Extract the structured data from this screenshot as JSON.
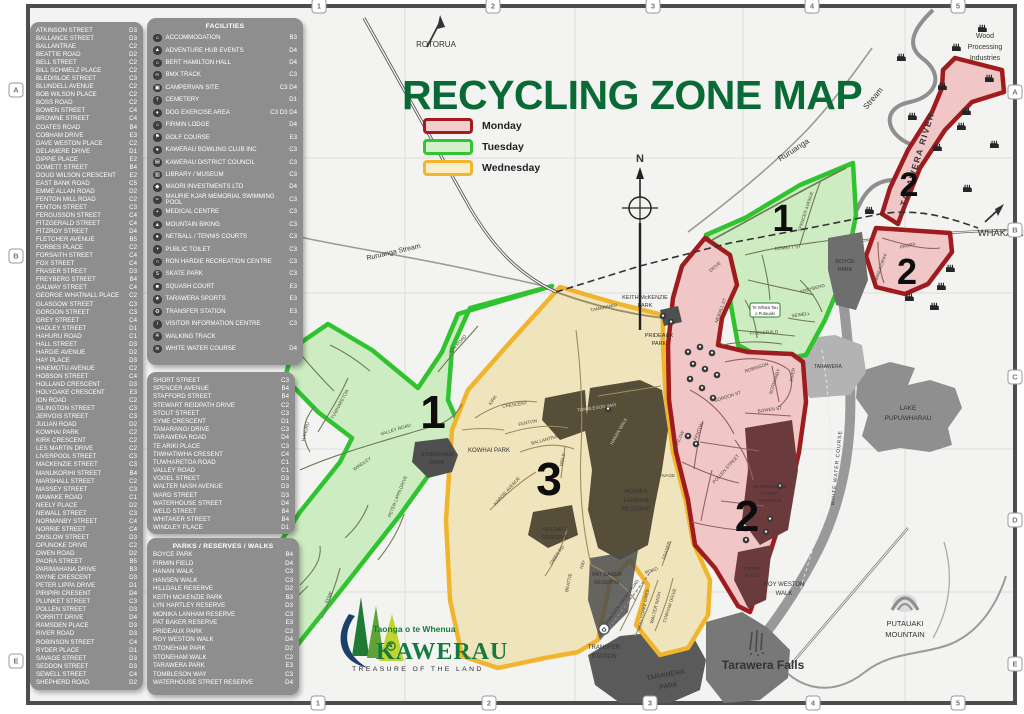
{
  "title": "RECYCLING ZONE MAP",
  "legend": {
    "items": [
      {
        "label": "Monday",
        "stroke": "#A6191E",
        "fill": "#F2CFCF"
      },
      {
        "label": "Tuesday",
        "stroke": "#33C433",
        "fill": "#D5EFCB"
      },
      {
        "label": "Wednesday",
        "stroke": "#F2B52D",
        "fill": "#F7EFC9"
      }
    ]
  },
  "grid": {
    "cols": [
      "1",
      "2",
      "3",
      "4",
      "5"
    ],
    "rows": [
      "A",
      "B",
      "C",
      "D",
      "E"
    ]
  },
  "streets_panel_1": {
    "items": [
      {
        "name": "ATKINSON STREET",
        "ref": "D3"
      },
      {
        "name": "BALLANCE STREET",
        "ref": "D3"
      },
      {
        "name": "BALLANTRAE",
        "ref": "C2"
      },
      {
        "name": "BEATTIE ROAD",
        "ref": "D2"
      },
      {
        "name": "BELL STREET",
        "ref": "C2"
      },
      {
        "name": "BILL SCHMELZ PLACE",
        "ref": "C2"
      },
      {
        "name": "BLEDISLOE STREET",
        "ref": "C3"
      },
      {
        "name": "BLUNDELL AVENUE",
        "ref": "C2"
      },
      {
        "name": "BOB WILSON PLACE",
        "ref": "C2"
      },
      {
        "name": "BOSS ROAD",
        "ref": "C2"
      },
      {
        "name": "BOWEN STREET",
        "ref": "C4"
      },
      {
        "name": "BROWNE STREET",
        "ref": "C4"
      },
      {
        "name": "COATES ROAD",
        "ref": "B4"
      },
      {
        "name": "COBHAM DRIVE",
        "ref": "E3"
      },
      {
        "name": "DAVE WESTON PLACE",
        "ref": "C2"
      },
      {
        "name": "DELAMERE DRIVE",
        "ref": "D1"
      },
      {
        "name": "DIPPIE PLACE",
        "ref": "E2"
      },
      {
        "name": "DOMETT STREET",
        "ref": "B4"
      },
      {
        "name": "DOUG WILSON CRESCENT",
        "ref": "E2"
      },
      {
        "name": "EAST BANK ROAD",
        "ref": "C5"
      },
      {
        "name": "EMME ALLAN ROAD",
        "ref": "D2"
      },
      {
        "name": "FENTON MILL ROAD",
        "ref": "C2"
      },
      {
        "name": "FENTON STREET",
        "ref": "C3"
      },
      {
        "name": "FERGUSSON STREET",
        "ref": "C4"
      },
      {
        "name": "FITZGERALD STREET",
        "ref": "C4"
      },
      {
        "name": "FITZROY STREET",
        "ref": "D4"
      },
      {
        "name": "FLETCHER AVENUE",
        "ref": "B5"
      },
      {
        "name": "FORBES PLACE",
        "ref": "C2"
      },
      {
        "name": "FORSAITH STREET",
        "ref": "C4"
      },
      {
        "name": "FOX STREET",
        "ref": "C4"
      },
      {
        "name": "FRASER STREET",
        "ref": "D3"
      },
      {
        "name": "FREYBERG STREET",
        "ref": "B4"
      },
      {
        "name": "GALWAY STREET",
        "ref": "C4"
      },
      {
        "name": "GEORGE WHATNALL PLACE",
        "ref": "C2"
      },
      {
        "name": "GLASGOW STREET",
        "ref": "C3"
      },
      {
        "name": "GORDON STREET",
        "ref": "C3"
      },
      {
        "name": "GREY STREET",
        "ref": "C4"
      },
      {
        "name": "HADLEY STREET",
        "ref": "D1"
      },
      {
        "name": "HAHURU ROAD",
        "ref": "C1"
      },
      {
        "name": "HALL STREET",
        "ref": "D3"
      },
      {
        "name": "HARDIE AVENUE",
        "ref": "D2"
      },
      {
        "name": "HAY PLACE",
        "ref": "D3"
      },
      {
        "name": "HINEMOTU AVENUE",
        "ref": "C2"
      },
      {
        "name": "HOBSON STREET",
        "ref": "C4"
      },
      {
        "name": "HOLLAND CRESCENT",
        "ref": "D3"
      },
      {
        "name": "HOLYOAKE CRESCENT",
        "ref": "E3"
      },
      {
        "name": "ION ROAD",
        "ref": "C2"
      },
      {
        "name": "ISLINGTON STREET",
        "ref": "C3"
      },
      {
        "name": "JERVOIS STREET",
        "ref": "C3"
      },
      {
        "name": "JULIAN ROAD",
        "ref": "D2"
      },
      {
        "name": "KOWHAI PARK",
        "ref": "C2"
      },
      {
        "name": "KIRK CRESCENT",
        "ref": "C2"
      },
      {
        "name": "LES MARTIN DRIVE",
        "ref": "C2"
      },
      {
        "name": "LIVERPOOL STREET",
        "ref": "C3"
      },
      {
        "name": "MACKENZIE STREET",
        "ref": "C3"
      },
      {
        "name": "MANUKORIHI STREET",
        "ref": "B4"
      },
      {
        "name": "MARSHALL STREET",
        "ref": "C2"
      },
      {
        "name": "MASSEY STREET",
        "ref": "C3"
      },
      {
        "name": "MAWAKE ROAD",
        "ref": "C1"
      },
      {
        "name": "NEELY PLACE",
        "ref": "D2"
      },
      {
        "name": "NEWALL STREET",
        "ref": "C3"
      },
      {
        "name": "NORMANBY STREET",
        "ref": "C4"
      },
      {
        "name": "NORRIE STREET",
        "ref": "C4"
      },
      {
        "name": "ONSLOW STREET",
        "ref": "D3"
      },
      {
        "name": "OPUNOKE DRIVE",
        "ref": "C2"
      },
      {
        "name": "OWEN ROAD",
        "ref": "D2"
      },
      {
        "name": "PAORA STREET",
        "ref": "B5"
      },
      {
        "name": "PARIMAHANA DRIVE",
        "ref": "B3"
      },
      {
        "name": "PAYNE CRESCENT",
        "ref": "D3"
      },
      {
        "name": "PETER LIPPA DRIVE",
        "ref": "D1"
      },
      {
        "name": "PIRIPIRI CRESENT",
        "ref": "D4"
      },
      {
        "name": "PLUNKET STREET",
        "ref": "C3"
      },
      {
        "name": "POLLEN STREET",
        "ref": "D3"
      },
      {
        "name": "PORRITT DRIVE",
        "ref": "D4"
      },
      {
        "name": "RAMSDEN PLACE",
        "ref": "D3"
      },
      {
        "name": "RIVER ROAD",
        "ref": "D3"
      },
      {
        "name": "ROBINSON STREET",
        "ref": "C4"
      },
      {
        "name": "RYDER PLACE",
        "ref": "D1"
      },
      {
        "name": "SAVAGE STREET",
        "ref": "D3"
      },
      {
        "name": "SEDDON STREET",
        "ref": "D3"
      },
      {
        "name": "SEWELL STREET",
        "ref": "C4"
      },
      {
        "name": "SHEPHERD ROAD",
        "ref": "D2"
      }
    ]
  },
  "facilities_panel": {
    "title": "FACILITIES",
    "items": [
      {
        "glyph": "⌂",
        "name": "ACCOMMODATION",
        "ref": "B3"
      },
      {
        "glyph": "▲",
        "name": "ADVENTURE HUB EVENTS",
        "ref": "D4"
      },
      {
        "glyph": "⌂",
        "name": "BERT HAMILTON HALL",
        "ref": "D4"
      },
      {
        "glyph": "∞",
        "name": "BMX TRACK",
        "ref": "C3"
      },
      {
        "glyph": "▣",
        "name": "CAMPERVAN SITE",
        "ref": "C3 D4"
      },
      {
        "glyph": "†",
        "name": "CEMETERY",
        "ref": "D1"
      },
      {
        "glyph": "♦",
        "name": "DOG EXERCISE AREA",
        "ref": "C3 D3 D4"
      },
      {
        "glyph": "⌂",
        "name": "FIRMIN LODGE",
        "ref": "D4"
      },
      {
        "glyph": "⚑",
        "name": "GOLF COURSE",
        "ref": "E3"
      },
      {
        "glyph": "●",
        "name": "KAWERAU BOWLING CLUB INC",
        "ref": "C3"
      },
      {
        "glyph": "▤",
        "name": "KAWERAU DISTRICT COUNCIL",
        "ref": "C3"
      },
      {
        "glyph": "▥",
        "name": "LIBRARY / MUSEUM",
        "ref": "C3"
      },
      {
        "glyph": "◆",
        "name": "MAORI INVESTMENTS LTD",
        "ref": "D4"
      },
      {
        "glyph": "≈",
        "name": "MAURIE KJAR MEMORIAL SWIMMING POOL",
        "ref": "C3"
      },
      {
        "glyph": "+",
        "name": "MEDICAL CENTRE",
        "ref": "C3"
      },
      {
        "glyph": "▲",
        "name": "MOUNTAIN BIKING",
        "ref": "C3"
      },
      {
        "glyph": "●",
        "name": "NETBALL / TENNIS COURTS",
        "ref": "C3"
      },
      {
        "glyph": "◑",
        "name": "PUBLIC TOILET",
        "ref": "C3"
      },
      {
        "glyph": "∩",
        "name": "RON HARDIE RECREATION CENTRE",
        "ref": "C3"
      },
      {
        "glyph": "S",
        "name": "SKATE PARK",
        "ref": "C3"
      },
      {
        "glyph": "■",
        "name": "SQUASH COURT",
        "ref": "E3"
      },
      {
        "glyph": "★",
        "name": "TARAWERA SPORTS",
        "ref": "E3"
      },
      {
        "glyph": "♻",
        "name": "TRANSFER STATION",
        "ref": "E3"
      },
      {
        "glyph": "i",
        "name": "VISITOR INFORMATION CENTRE",
        "ref": "C3"
      },
      {
        "glyph": "※",
        "name": "WALKING TRACK",
        "ref": ""
      },
      {
        "glyph": "≋",
        "name": "WHITE WATER COURSE",
        "ref": "D4"
      }
    ]
  },
  "streets_panel_2": {
    "items": [
      {
        "name": "SHORT STREET",
        "ref": "C3"
      },
      {
        "name": "SPENCER AVENUE",
        "ref": "B4"
      },
      {
        "name": "STAFFORD STREET",
        "ref": "B4"
      },
      {
        "name": "STEWART REIDPATH DRIVE",
        "ref": "C2"
      },
      {
        "name": "STOUT STREET",
        "ref": "C3"
      },
      {
        "name": "SYME CRESCENT",
        "ref": "D1"
      },
      {
        "name": "TAMARANGI DRIVE",
        "ref": "C3"
      },
      {
        "name": "TARAWERA ROAD",
        "ref": "D4"
      },
      {
        "name": "TE ARIKI PLACE",
        "ref": "C3"
      },
      {
        "name": "TIWHATIWHA CRESENT",
        "ref": "C4"
      },
      {
        "name": "TUWHARETOA ROAD",
        "ref": "C1"
      },
      {
        "name": "VALLEY ROAD",
        "ref": "C1"
      },
      {
        "name": "VOGEL STREET",
        "ref": "D3"
      },
      {
        "name": "WALTER NASH AVENUE",
        "ref": "D3"
      },
      {
        "name": "WARD STREET",
        "ref": "D3"
      },
      {
        "name": "WATERHOUSE STREET",
        "ref": "D4"
      },
      {
        "name": "WELD STREET",
        "ref": "B4"
      },
      {
        "name": "WHITAKER STREET",
        "ref": "B4"
      },
      {
        "name": "WINDLEY PLACE",
        "ref": "D1"
      }
    ]
  },
  "parks_panel": {
    "title": "PARKS / RESERVES / WALKS",
    "items": [
      {
        "name": "BOYCE PARK",
        "ref": "B4"
      },
      {
        "name": "FIRMIN FIELD",
        "ref": "D4"
      },
      {
        "name": "HANAN WALK",
        "ref": "C3"
      },
      {
        "name": "HANSEN WALK",
        "ref": "C3"
      },
      {
        "name": "HILLDALE RESERVE",
        "ref": "D2"
      },
      {
        "name": "KEITH MCKENZIE PARK",
        "ref": "B3"
      },
      {
        "name": "LYN HARTLEY RESERVE",
        "ref": "D3"
      },
      {
        "name": "MONIKA LANHAM RESERVE",
        "ref": "C3"
      },
      {
        "name": "PAT BAKER RESERVE",
        "ref": "E3"
      },
      {
        "name": "PRIDEAUX PARK",
        "ref": "C3"
      },
      {
        "name": "ROY WESTON WALK",
        "ref": "D4"
      },
      {
        "name": "STONEHAM PARK",
        "ref": "D2"
      },
      {
        "name": "STONEHAM WALK",
        "ref": "C2"
      },
      {
        "name": "TARAWERA PARK",
        "ref": "E3"
      },
      {
        "name": "TOMBLESON WAY",
        "ref": "C3"
      },
      {
        "name": "WATERHOUSE STREET RESERVE",
        "ref": "D4"
      }
    ]
  },
  "logo": {
    "tagline_top": "Taonga o te Whenua",
    "name": "KAWERAU",
    "tagline_bottom": "TREASURE OF THE LAND"
  },
  "map": {
    "colors": {
      "monday_zone": "#9E1B1E",
      "tuesday_zone": "#2FC32F",
      "wednesday_zone": "#F0B52C",
      "title_green": "#0A6A36"
    },
    "labels": {
      "rotorua": "ROTORUA",
      "whakatane": "WHAKATANE",
      "tarawera_river": "TARAWERA RIVER",
      "ruruanga_upper": [
        "Ruruanga",
        "Stream"
      ],
      "ruruanga_lower": "Ruruanga Stream",
      "wood_processing": [
        "Wood",
        "Processing",
        "Industries"
      ],
      "north": "N",
      "lake": [
        "LAKE",
        "PUPUWHARAU"
      ],
      "putauaki": [
        "PUTAUAKI",
        "MOUNTAIN"
      ],
      "tarawera_falls": "Tarawera Falls",
      "transfer_station": [
        "TRANSFER",
        "STATION"
      ],
      "tarawera_park": [
        "TARAWERA",
        "PARK"
      ],
      "stoneham_park": [
        "STONEHAM",
        "PARK"
      ],
      "kowhai_park": "KOWHAI PARK",
      "keith_mckenzie_park": [
        "KEITH McKENZIE",
        "PARK"
      ],
      "prideaux_park": [
        "PRIDEAUX",
        "PARK"
      ],
      "monika_lanham": [
        "MONIKA",
        "LANHAM",
        "RESERVE"
      ],
      "hilldale": [
        "HILLDALE",
        "RESERVE"
      ],
      "pat_baker": [
        "PAT BAKER",
        "RESERVE"
      ],
      "roy_weston": [
        "ROY WESTON",
        "WALK"
      ],
      "boyce_park": [
        "BOYCE",
        "PARK"
      ],
      "waterhouse": [
        "WATERHOUSE",
        "STREET",
        "RESERVE"
      ],
      "firmin_field": [
        "FIRMIN",
        "FIELD"
      ],
      "tarawera_school": "TARAWERA",
      "te_whata": [
        "Te Whata Tau",
        "o Putauaki"
      ],
      "white_water": "WHITE WATER COURSE",
      "transfer_road": "TRANSFER STATION ROAD"
    },
    "zone_numbers": {
      "z1a": "1",
      "z1b": "1",
      "z2a": "2",
      "z2b": "2",
      "z2c": "2",
      "z3": "3"
    },
    "street_labels": [
      {
        "t": "TAMARANGI",
        "x": 604,
        "y": 309,
        "r": -12
      },
      {
        "t": "VALLEY ROAD",
        "x": 396,
        "y": 431,
        "r": -17
      },
      {
        "t": "TUWHARETOA",
        "x": 341,
        "y": 405,
        "r": -62
      },
      {
        "t": "HAHURU",
        "x": 307,
        "y": 432,
        "r": -75
      },
      {
        "t": "ION ROAD",
        "x": 459,
        "y": 345,
        "r": -48
      },
      {
        "t": "PETER LIPPA DRIVE",
        "x": 399,
        "y": 497,
        "r": -68
      },
      {
        "t": "SYME",
        "x": 330,
        "y": 598,
        "r": -65
      },
      {
        "t": "WINDLEY",
        "x": 363,
        "y": 465,
        "r": -35
      },
      {
        "t": "DOMETT ST",
        "x": 788,
        "y": 249,
        "r": -5
      },
      {
        "t": "SPENCER AVENUE",
        "x": 807,
        "y": 212,
        "r": -72
      },
      {
        "t": "FREYBERG",
        "x": 813,
        "y": 290,
        "r": -15
      },
      {
        "t": "SEWELL",
        "x": 801,
        "y": 316,
        "r": -8
      },
      {
        "t": "FITZGERALD",
        "x": 764,
        "y": 334,
        "r": -3
      },
      {
        "t": "NEWALL ST",
        "x": 722,
        "y": 311,
        "r": -70
      },
      {
        "t": "DRIVE",
        "x": 716,
        "y": 268,
        "r": -40
      },
      {
        "t": "ROBINSON",
        "x": 757,
        "y": 369,
        "r": -18
      },
      {
        "t": "NORMANBY",
        "x": 776,
        "y": 382,
        "r": -72
      },
      {
        "t": "BOWEN ST",
        "x": 770,
        "y": 411,
        "r": -8
      },
      {
        "t": "GORDON ST",
        "x": 728,
        "y": 398,
        "r": -18
      },
      {
        "t": "RIVER",
        "x": 794,
        "y": 375,
        "r": -80
      },
      {
        "t": "ONSLOW",
        "x": 680,
        "y": 441,
        "r": -65
      },
      {
        "t": "POLLEN STREET",
        "x": 727,
        "y": 470,
        "r": -48
      },
      {
        "t": "FENTON",
        "x": 700,
        "y": 432,
        "r": -68
      },
      {
        "t": "SAVAGE",
        "x": 666,
        "y": 477,
        "r": 0
      },
      {
        "t": "GLASGOW ST",
        "x": 624,
        "y": 389,
        "r": -10
      },
      {
        "t": "FENTON",
        "x": 528,
        "y": 424,
        "r": -12
      },
      {
        "t": "BALLANTRAE",
        "x": 546,
        "y": 441,
        "r": -15
      },
      {
        "t": "KIRK",
        "x": 494,
        "y": 401,
        "r": -55
      },
      {
        "t": "CRESCENT",
        "x": 515,
        "y": 406,
        "r": -8
      },
      {
        "t": "WELD",
        "x": 564,
        "y": 460,
        "r": -78
      },
      {
        "t": "HARDIE AVENUE",
        "x": 508,
        "y": 492,
        "r": -48
      },
      {
        "t": "OWEN RD",
        "x": 558,
        "y": 556,
        "r": -55
      },
      {
        "t": "BEATTIE",
        "x": 570,
        "y": 583,
        "r": -78
      },
      {
        "t": "HAY",
        "x": 584,
        "y": 565,
        "r": -70
      },
      {
        "t": "HOLLYOAKE CRES",
        "x": 645,
        "y": 610,
        "r": -78
      },
      {
        "t": "WALTER NASH",
        "x": 657,
        "y": 608,
        "r": -76
      },
      {
        "t": "COBHAM DRIVE",
        "x": 671,
        "y": 606,
        "r": -72
      },
      {
        "t": "FRASER",
        "x": 668,
        "y": 551,
        "r": -72
      },
      {
        "t": "ROAD",
        "x": 652,
        "y": 572,
        "r": -20
      },
      {
        "t": "TOMBLESON WAY",
        "x": 597,
        "y": 409,
        "r": -8,
        "light": true
      },
      {
        "t": "HANAN WALK",
        "x": 620,
        "y": 432,
        "r": -60,
        "light": true
      },
      {
        "t": "PAORA",
        "x": 908,
        "y": 247,
        "r": -14
      },
      {
        "t": "MANUKORIHI",
        "x": 882,
        "y": 268,
        "r": -70
      }
    ],
    "icons": {
      "transfer_glyph": "♻",
      "factories": [
        [
          978,
          24
        ],
        [
          952,
          43
        ],
        [
          897,
          53
        ],
        [
          985,
          74
        ],
        [
          938,
          82
        ],
        [
          962,
          107
        ],
        [
          908,
          112
        ],
        [
          957,
          122
        ],
        [
          990,
          140
        ],
        [
          933,
          143
        ],
        [
          963,
          184
        ],
        [
          865,
          206
        ],
        [
          946,
          264
        ],
        [
          937,
          282
        ],
        [
          905,
          293
        ],
        [
          930,
          302
        ]
      ],
      "facility_dots": [
        [
          688,
          352
        ],
        [
          700,
          347
        ],
        [
          712,
          353
        ],
        [
          693,
          364
        ],
        [
          705,
          369
        ],
        [
          717,
          375
        ],
        [
          690,
          379
        ],
        [
          702,
          388
        ],
        [
          713,
          398
        ],
        [
          688,
          436
        ],
        [
          696,
          444
        ],
        [
          663,
          316
        ],
        [
          671,
          322
        ],
        [
          770,
          519
        ],
        [
          766,
          532
        ],
        [
          746,
          540
        ],
        [
          780,
          486
        ],
        [
          608,
          409
        ]
      ]
    }
  }
}
